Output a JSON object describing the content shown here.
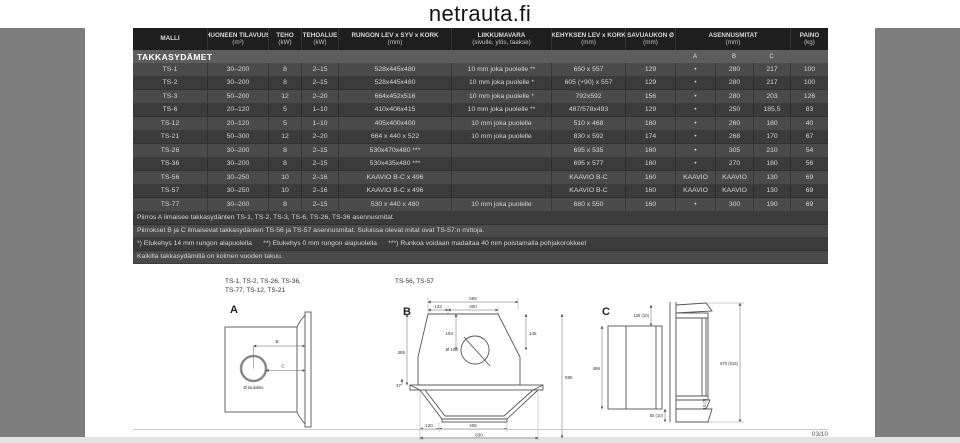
{
  "logo": "netrauta.fi",
  "footer": {
    "page": "03/10"
  },
  "table": {
    "section_title": "TAKKASYDÄMET",
    "sub_headers": [
      "A",
      "B",
      "C"
    ],
    "columns": [
      {
        "label": "MALLI",
        "unit": ""
      },
      {
        "label": "HUONEEN TILAVUUS",
        "unit": "(m³)"
      },
      {
        "label": "TEHO",
        "unit": "(kW)"
      },
      {
        "label": "TEHOALUE",
        "unit": "(kW)"
      },
      {
        "label": "RUNGON LEV x SYV x KORK",
        "unit": "(mm)"
      },
      {
        "label": "LIIKKUMAVARA",
        "unit": "(sivulle, ylös, taakse)"
      },
      {
        "label": "KEHYKSEN LEV x KORK",
        "unit": "(mm)"
      },
      {
        "label": "SAVUAUKON Ø",
        "unit": "(mm)"
      },
      {
        "label": "ASENNUSMITAT",
        "unit": "(mm)",
        "span": 3
      },
      {
        "label": "PAINO",
        "unit": "(kg)"
      }
    ],
    "rows": [
      [
        "TS-1",
        "30–200",
        "8",
        "2–15",
        "528x445x480",
        "10 mm joka puolelle **",
        "650 x 557",
        "129",
        "•",
        "280",
        "217",
        "100"
      ],
      [
        "TS-2",
        "30–200",
        "8",
        "2–15",
        "528x445x480",
        "10 mm joka puolelle *",
        "605 (+90) x 557",
        "129",
        "•",
        "280",
        "217",
        "100"
      ],
      [
        "TS-3",
        "50–200",
        "12",
        "2–20",
        "664x452x516",
        "10 mm joka puolelle *",
        "792x592",
        "156",
        "•",
        "280",
        "203",
        "126"
      ],
      [
        "TS-6",
        "20–120",
        "5",
        "1–10",
        "410x406x415",
        "10 mm joka puolelle **",
        "487/578x493",
        "129",
        "•",
        "250",
        "185,5",
        "83"
      ],
      [
        "TS-12",
        "20–120",
        "5",
        "1–10",
        "405x400x400",
        "10 mm joka puolelle",
        "510 x 468",
        "160",
        "•",
        "260",
        "180",
        "40"
      ],
      [
        "TS-21",
        "50–300",
        "12",
        "2–20",
        "664 x 440 x 522",
        "10 mm joka puolelle",
        "830 x 592",
        "174",
        "•",
        "268",
        "170",
        "67"
      ],
      [
        "TS-26",
        "30–200",
        "8",
        "2–15",
        "530x470x480 ***",
        "",
        "695 x 535",
        "160",
        "•",
        "305",
        "210",
        "54"
      ],
      [
        "TS-36",
        "30–200",
        "8",
        "2–15",
        "530x435x480 ***",
        "",
        "695 x 577",
        "160",
        "•",
        "270",
        "180",
        "56"
      ],
      [
        "TS-56",
        "30–250",
        "10",
        "2–16",
        "KAAVIO B-C x 496",
        "",
        "KAAVIO B-C",
        "160",
        "KAAVIO",
        "KAAVIO",
        "130",
        "69"
      ],
      [
        "TS-57",
        "30–250",
        "10",
        "2–16",
        "KAAVIO B-C x 496",
        "",
        "KAAVIO B-C",
        "160",
        "KAAVIO",
        "KAAVIO",
        "130",
        "69"
      ],
      [
        "TS-77",
        "30–200",
        "8",
        "2–15",
        "530 x 440 x 480",
        "10 mm joka puolelle",
        "680 x 550",
        "160",
        "•",
        "300",
        "190",
        "69"
      ]
    ],
    "notes": [
      "Piirros A ilmaisee takkasydänten TS-1, TS-2, TS-3, TS-6, TS-26, TS-36 asennusmitat.",
      "Piirrokset B ja C ilmaisevat takkasydänten TS-56 ja TS-57 asennusmitat. Suluissa olevat mitat ovat TS-57:n mittoja.",
      "*) Etukehys 14 mm rungon alapuolella      **) Etukehys 0 mm rungon alapuolella      ***) Runkoa voidaan madaltaa 40 mm poistamalla pohjakorokkeet",
      "Kaikilla takkasydämillä on kolmen vuoden takuu."
    ]
  },
  "diagrams": {
    "a": {
      "title_line1": "TS-1, TS-2, TS-26, TS-36,",
      "title_line2": "TS-77, TS-12, TS-21",
      "label": "A",
      "dim_b": "B",
      "dim_c": "C",
      "hole_label": "Ø taulukko"
    },
    "b": {
      "title": "TS-56, TS-57",
      "label": "B",
      "dims": {
        "top_width": "565",
        "left": "133",
        "center": "300",
        "hole": "Ø 160",
        "upper_left": "194",
        "left_height": "365",
        "upper_right": "145",
        "total_height": "595",
        "shelf": "37",
        "foot_inset": "120",
        "opening_width": "406",
        "base_width": "830"
      }
    },
    "c": {
      "label": "C",
      "dims": {
        "top_offset": "125 (10)",
        "back_height": "496",
        "bottom_offset": "50 (10)",
        "total_height": "670 (515)",
        "lip": "10 (7)"
      }
    }
  }
}
